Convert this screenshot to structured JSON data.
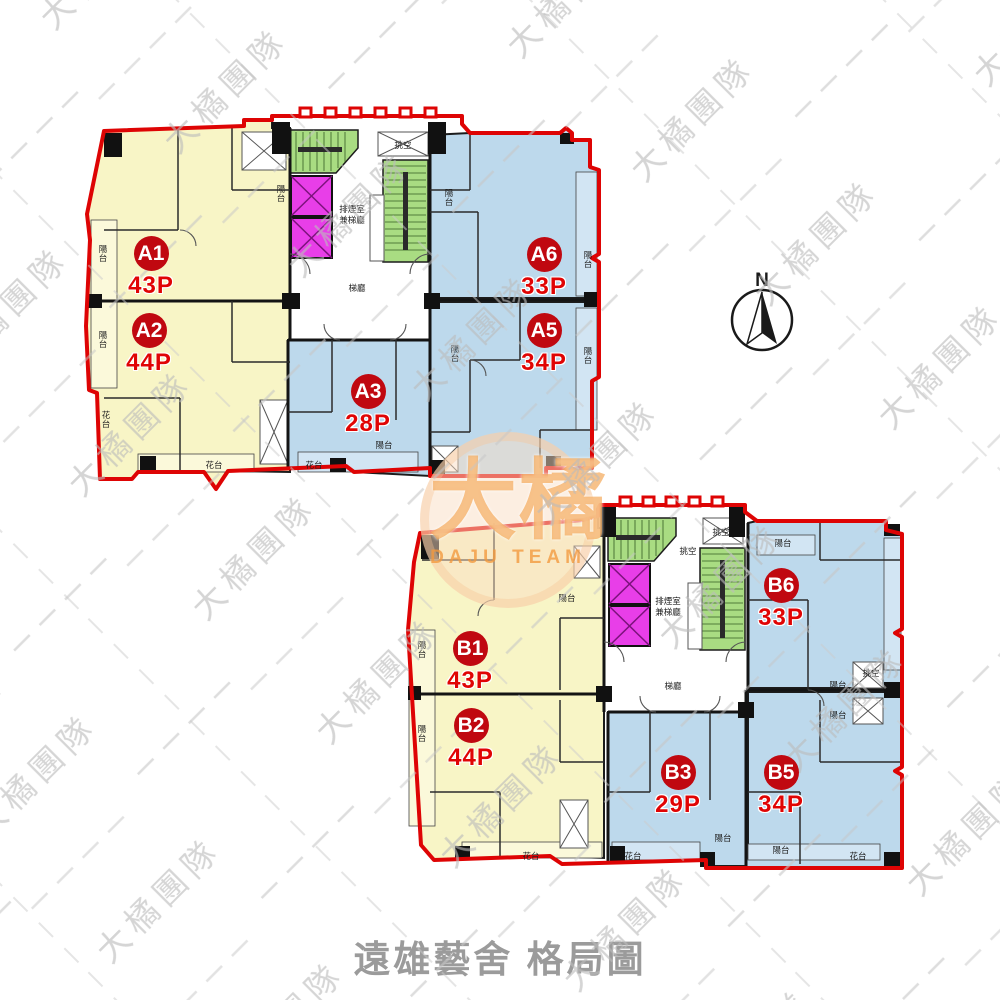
{
  "title": {
    "text": "遠雄藝舍 格局圖"
  },
  "compass": {
    "label": "N"
  },
  "watermark": {
    "repeat_text": "大橘團隊"
  },
  "logo": {
    "cn": "大橘",
    "en": "DAJU TEAM"
  },
  "colors": {
    "outline_red": "#de0404",
    "unit_yellow": "#f8f5c6",
    "unit_blue": "#bdd9ec",
    "stair_green": "#a9dc82",
    "elevator_magenta": "#e83ee8",
    "badge_red": "#c00810",
    "area_text_red": "#e00404",
    "title_gray": "#9b9b9b",
    "watermark_gray": "#bcbcbc"
  },
  "plans": [
    {
      "name": "A",
      "units": [
        {
          "id": "A1",
          "area": "43P"
        },
        {
          "id": "A2",
          "area": "44P"
        },
        {
          "id": "A3",
          "area": "28P"
        },
        {
          "id": "A5",
          "area": "34P"
        },
        {
          "id": "A6",
          "area": "33P"
        }
      ]
    },
    {
      "name": "B",
      "units": [
        {
          "id": "B1",
          "area": "43P"
        },
        {
          "id": "B2",
          "area": "44P"
        },
        {
          "id": "B3",
          "area": "29P"
        },
        {
          "id": "B5",
          "area": "34P"
        },
        {
          "id": "B6",
          "area": "33P"
        }
      ]
    }
  ],
  "room_labels": [
    {
      "t": "陽台",
      "x": 103,
      "y": 252,
      "v": 1
    },
    {
      "t": "陽台",
      "x": 103,
      "y": 338,
      "v": 1
    },
    {
      "t": "陽台",
      "x": 281,
      "y": 192,
      "v": 1
    },
    {
      "t": "陽台",
      "x": 449,
      "y": 196,
      "v": 1
    },
    {
      "t": "陽台",
      "x": 588,
      "y": 258,
      "v": 1
    },
    {
      "t": "陽台",
      "x": 588,
      "y": 354,
      "v": 1
    },
    {
      "t": "陽台",
      "x": 384,
      "y": 448,
      "v": 0
    },
    {
      "t": "陽台",
      "x": 455,
      "y": 352,
      "v": 1
    },
    {
      "t": "花台",
      "x": 214,
      "y": 468,
      "v": 0
    },
    {
      "t": "花台",
      "x": 314,
      "y": 468,
      "v": 0
    },
    {
      "t": "花台",
      "x": 106,
      "y": 418,
      "v": 1
    },
    {
      "t": "排煙室",
      "x": 352,
      "y": 212,
      "v": 0
    },
    {
      "t": "兼梯廳",
      "x": 352,
      "y": 223,
      "v": 0
    },
    {
      "t": "梯廳",
      "x": 357,
      "y": 291,
      "v": 0
    },
    {
      "t": "挑空",
      "x": 403,
      "y": 148,
      "v": 0
    },
    {
      "t": "陽台",
      "x": 422,
      "y": 648,
      "v": 1
    },
    {
      "t": "陽台",
      "x": 422,
      "y": 732,
      "v": 1
    },
    {
      "t": "陽台",
      "x": 567,
      "y": 601,
      "v": 0
    },
    {
      "t": "陽台",
      "x": 783,
      "y": 546,
      "v": 0
    },
    {
      "t": "陽台",
      "x": 838,
      "y": 688,
      "v": 0
    },
    {
      "t": "陽台",
      "x": 838,
      "y": 718,
      "v": 0
    },
    {
      "t": "挑空",
      "x": 871,
      "y": 676,
      "v": 0
    },
    {
      "t": "陽台",
      "x": 723,
      "y": 841,
      "v": 0
    },
    {
      "t": "陽台",
      "x": 781,
      "y": 853,
      "v": 0
    },
    {
      "t": "花台",
      "x": 531,
      "y": 859,
      "v": 0
    },
    {
      "t": "花台",
      "x": 633,
      "y": 859,
      "v": 0
    },
    {
      "t": "花台",
      "x": 858,
      "y": 859,
      "v": 0
    },
    {
      "t": "排煙室",
      "x": 668,
      "y": 604,
      "v": 0
    },
    {
      "t": "兼梯廳",
      "x": 668,
      "y": 615,
      "v": 0
    },
    {
      "t": "梯廳",
      "x": 673,
      "y": 689,
      "v": 0
    },
    {
      "t": "挑空",
      "x": 721,
      "y": 535,
      "v": 0
    },
    {
      "t": "挑空",
      "x": 688,
      "y": 554,
      "v": 0
    }
  ]
}
